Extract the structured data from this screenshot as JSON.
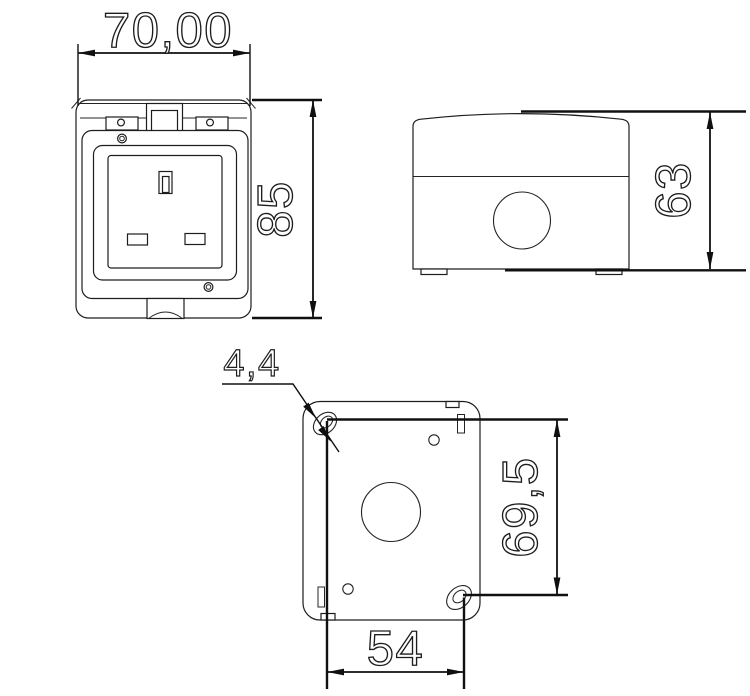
{
  "drawing": {
    "background": "#ffffff",
    "line_color": "#1d1d1d",
    "dimension_color": "#101010",
    "dimensions": {
      "width": "70,00",
      "height": "85",
      "depth": "63",
      "hole_diameter": "4,4",
      "hole_spacing_vertical": "69,5",
      "hole_spacing_horizontal": "54"
    }
  }
}
